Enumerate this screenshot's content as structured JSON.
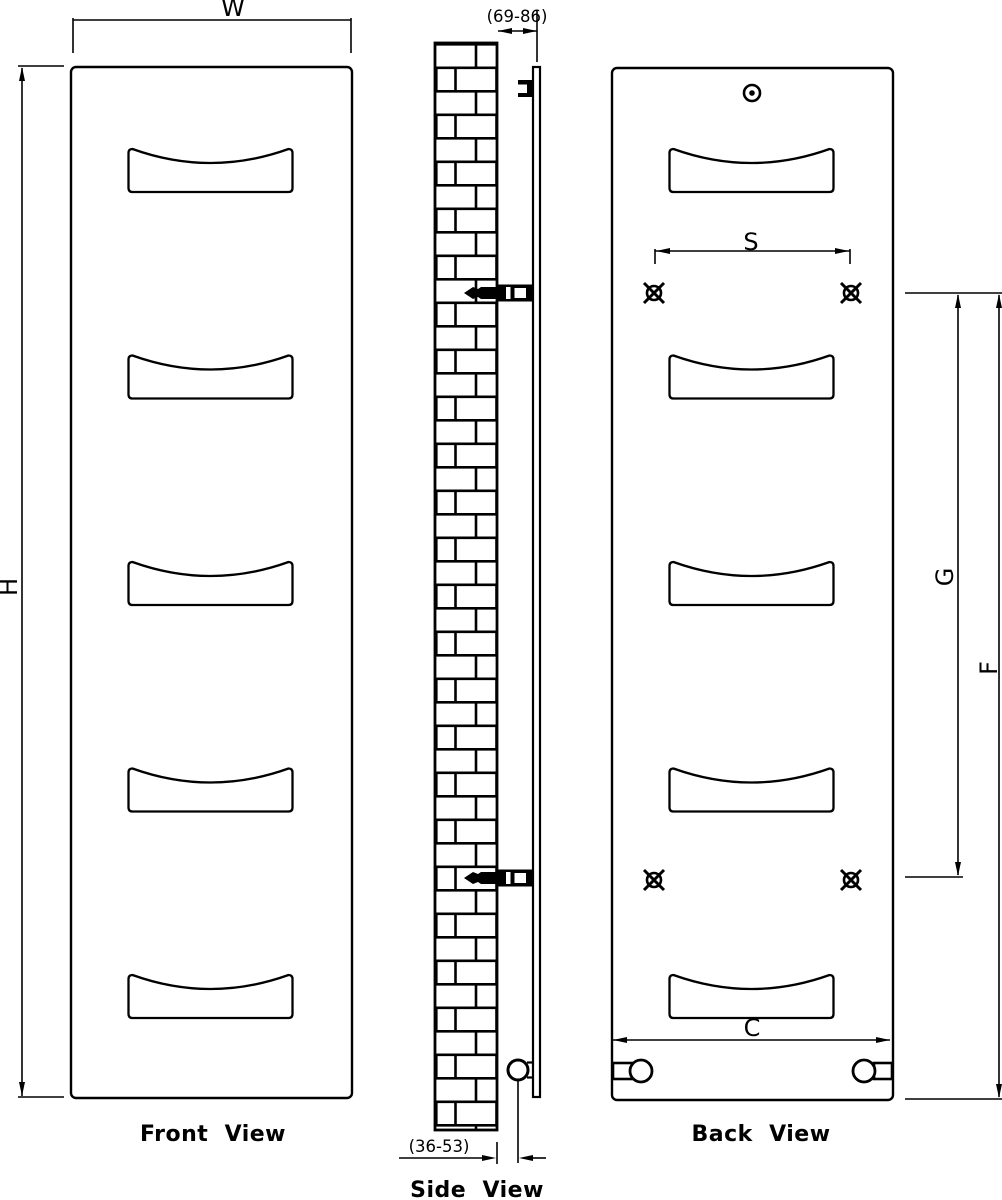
{
  "colors": {
    "ink": "#000000",
    "background": "#ffffff"
  },
  "views": {
    "front": {
      "caption": "Front  View"
    },
    "side": {
      "caption": "Side  View"
    },
    "back": {
      "caption": "Back  View"
    }
  },
  "dims": {
    "W": "W",
    "H": "H",
    "S": "S",
    "C": "C",
    "G": "G",
    "F": "F",
    "wall_offset_top": "(69-86)",
    "wall_offset_bottom": "(36-53)"
  },
  "figure": {
    "towel_slots_per_panel": 5,
    "mounting_points": 4,
    "wall_brackets": 2
  }
}
